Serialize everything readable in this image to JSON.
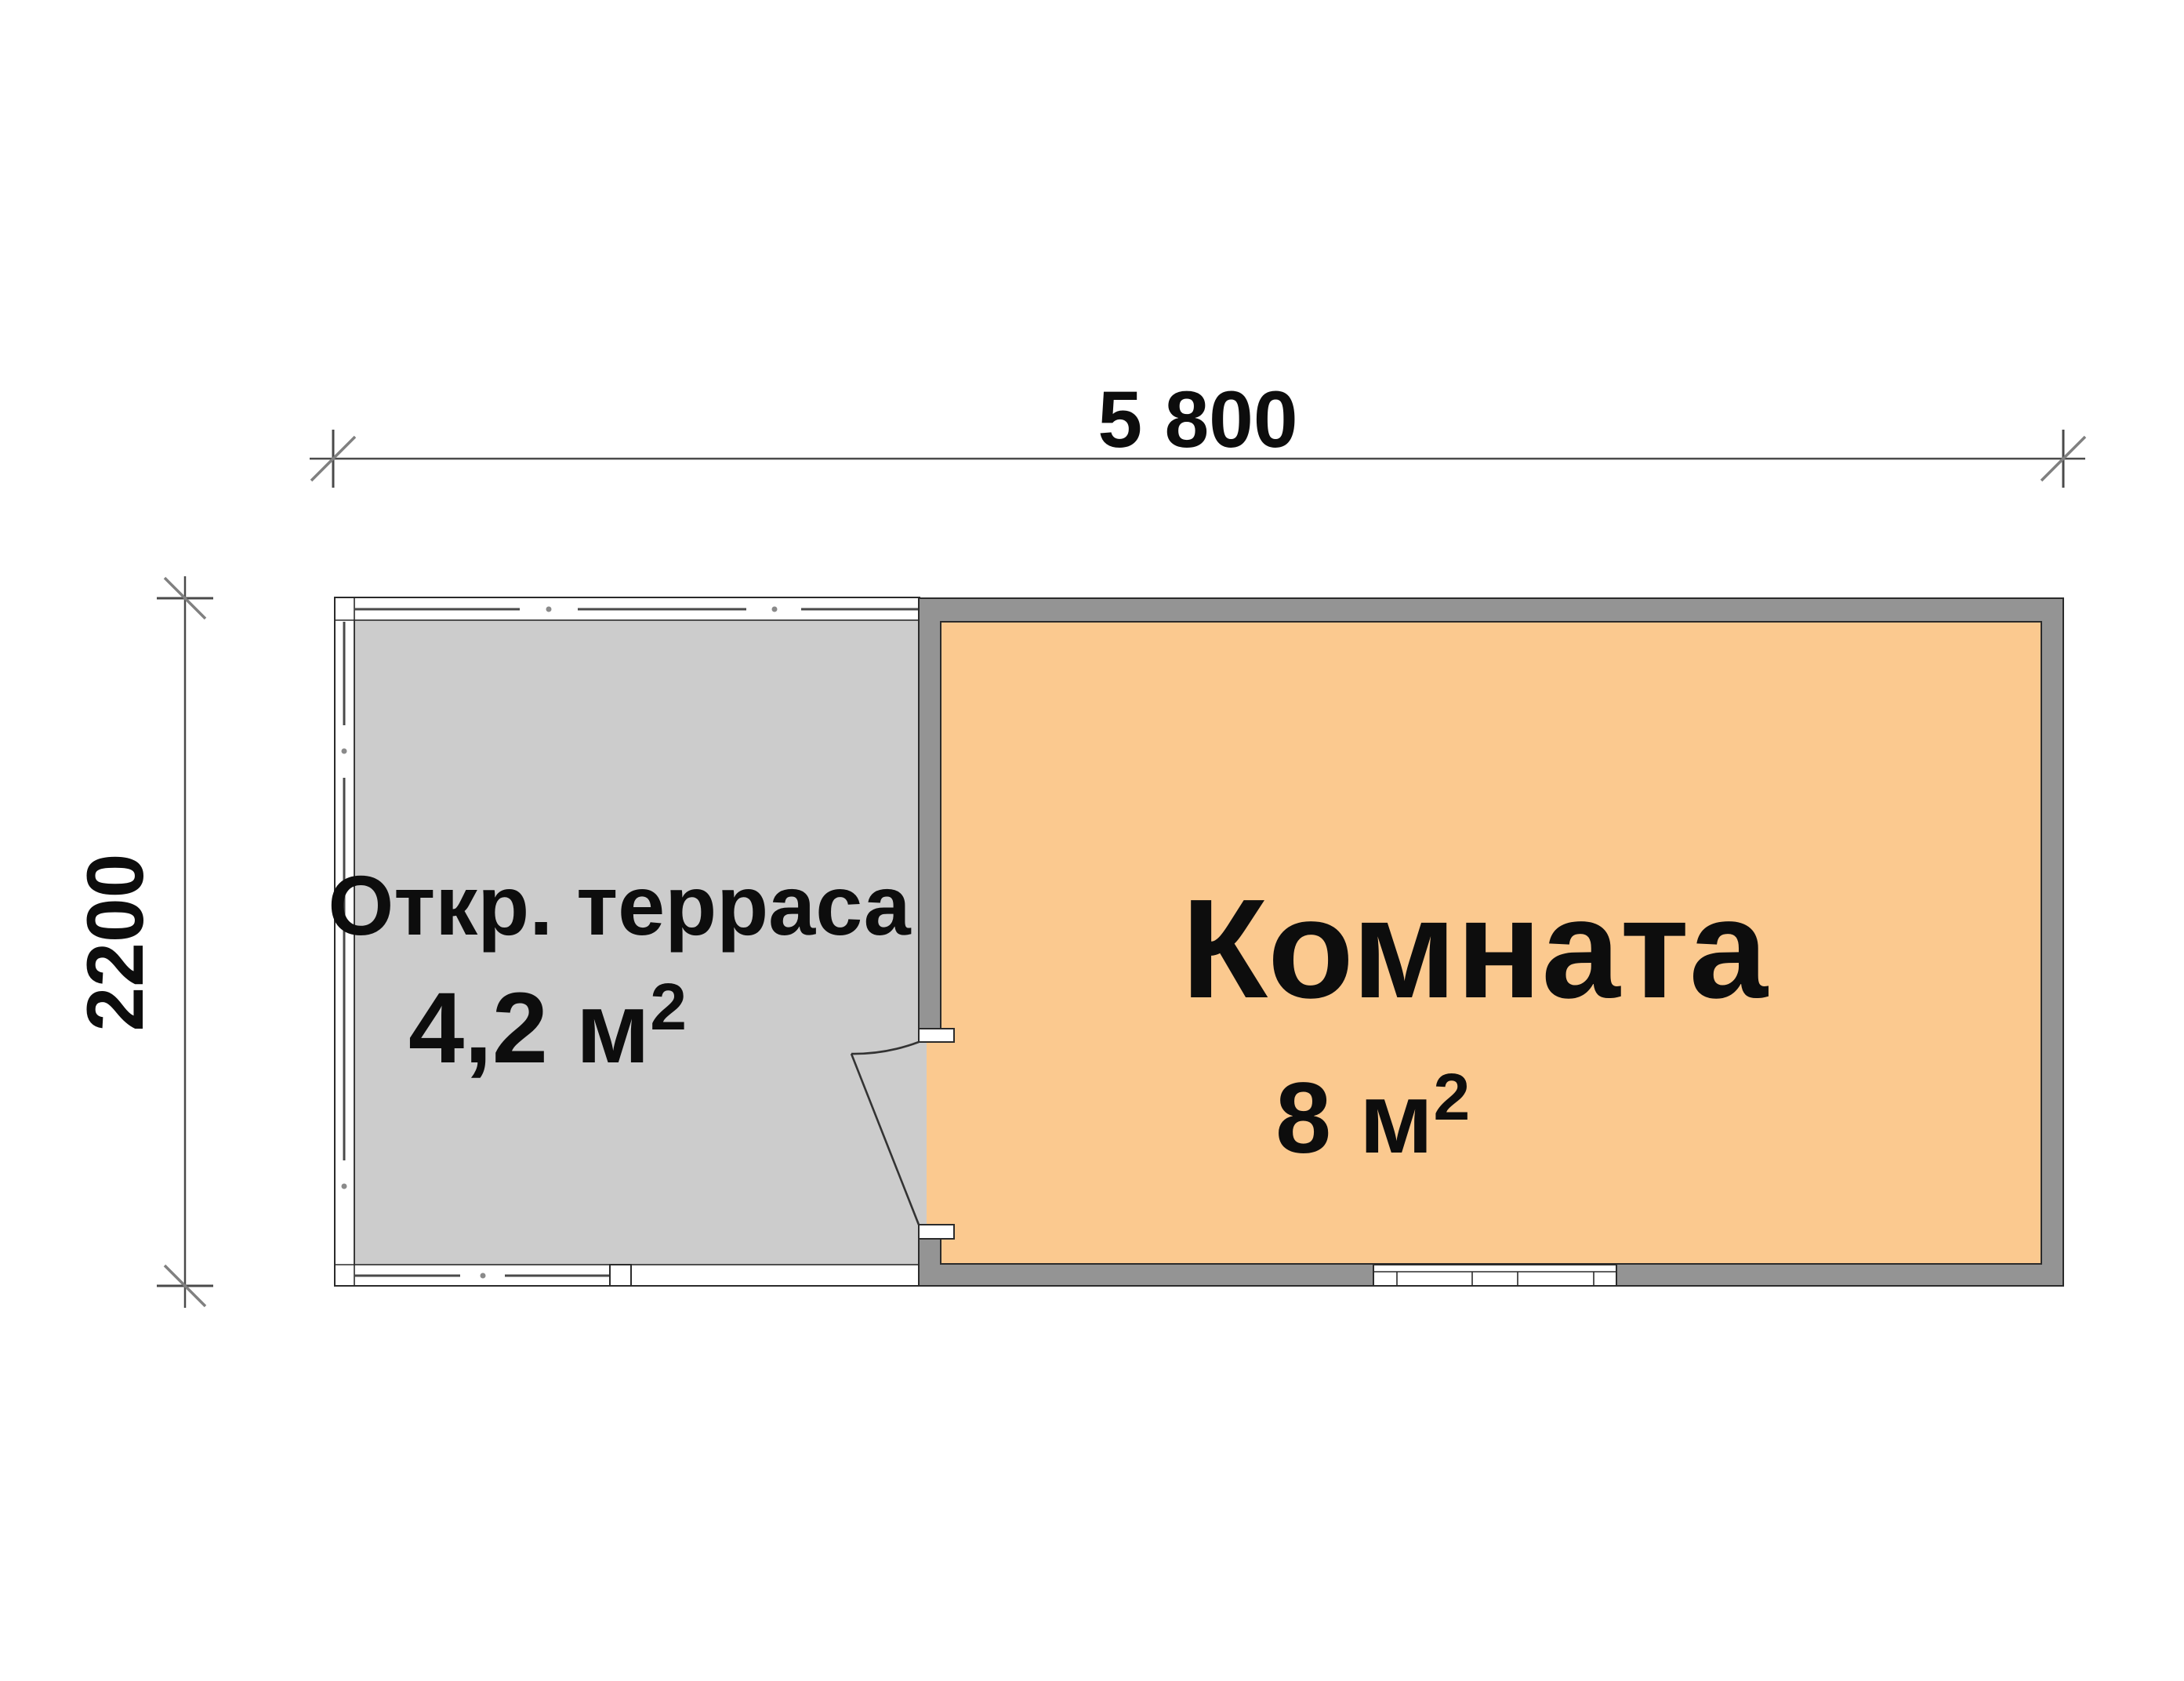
{
  "dimensions": {
    "width_label": "5 800",
    "height_label": "2200"
  },
  "rooms": {
    "terrace": {
      "name": "Откр. терраса",
      "area_value": "4,2 м",
      "area_sup": "2"
    },
    "room": {
      "name": "Комната",
      "area_value": "8 м",
      "area_sup": "2"
    }
  },
  "colors": {
    "background": "#ffffff",
    "terrace_floor": "#cccccc",
    "room_floor": "#fbc98f",
    "wall": "#949494",
    "fixture_white": "#ffffff"
  }
}
